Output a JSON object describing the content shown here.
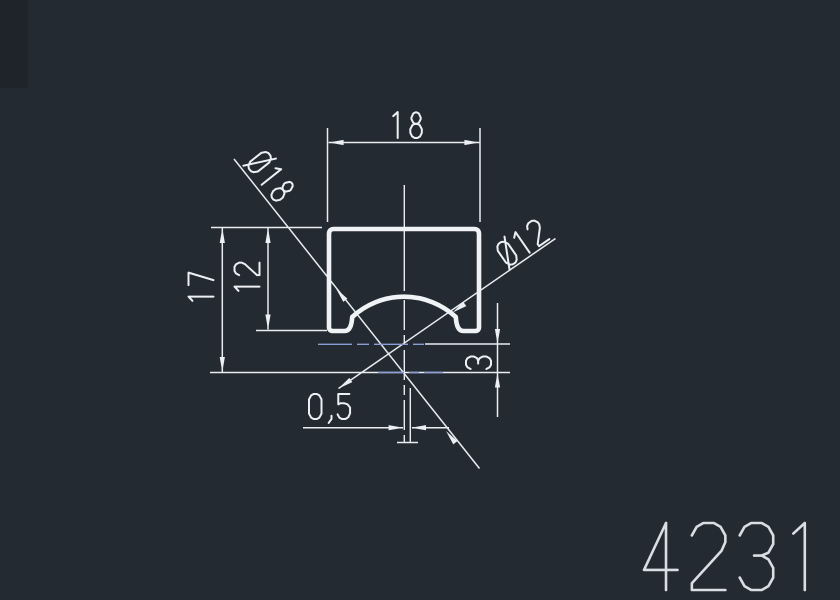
{
  "drawing": {
    "part_number": "4231",
    "background_color": "#242A31",
    "line_color": "#ECF0F4",
    "profile_color": "#F0F3F6",
    "centerline_color": "#8C9DD6",
    "part_number_color": "#D8DEE4",
    "dimensions": {
      "overall_width": "18",
      "overall_height_to_center": "17",
      "height_to_foot": "12",
      "center_offset_vertical": "3",
      "center_offset_horizontal": "0,5",
      "outer_arc_diameter": "Ø18",
      "inner_arc_diameter": "Ø12"
    },
    "annotations": [
      {
        "id": "dim-width-18",
        "text": "18",
        "x": 391,
        "y": 138,
        "rot": 0,
        "h": 26,
        "sw": 2.0
      },
      {
        "id": "dim-height-17",
        "text": "17",
        "x": 213.5,
        "y": 303,
        "rot": -90,
        "h": 25,
        "sw": 2.0
      },
      {
        "id": "dim-height-12",
        "text": "12",
        "x": 259.5,
        "y": 293,
        "rot": -90,
        "h": 25,
        "sw": 2.0
      },
      {
        "id": "dim-offset-3",
        "text": "3",
        "x": 491,
        "y": 369,
        "rot": -90,
        "h": 25,
        "sw": 2.0
      },
      {
        "id": "dim-offset-05",
        "text": "0,5",
        "x": 309,
        "y": 419,
        "rot": 0,
        "h": 25,
        "sw": 2.0
      },
      {
        "id": "dim-dia-18",
        "text": "Ø18",
        "x": 246,
        "y": 165,
        "rot": 51.6,
        "h": 25,
        "sw": 2.0
      },
      {
        "id": "dim-dia-12",
        "text": "Ø12",
        "x": 509,
        "y": 267,
        "rot": -34.7,
        "h": 25,
        "sw": 2.0
      },
      {
        "id": "part-number",
        "text": "4231",
        "x": 644,
        "y": 590,
        "rot": 0,
        "h": 67,
        "sw": 2.6,
        "color": "#D8DEE4"
      }
    ]
  }
}
